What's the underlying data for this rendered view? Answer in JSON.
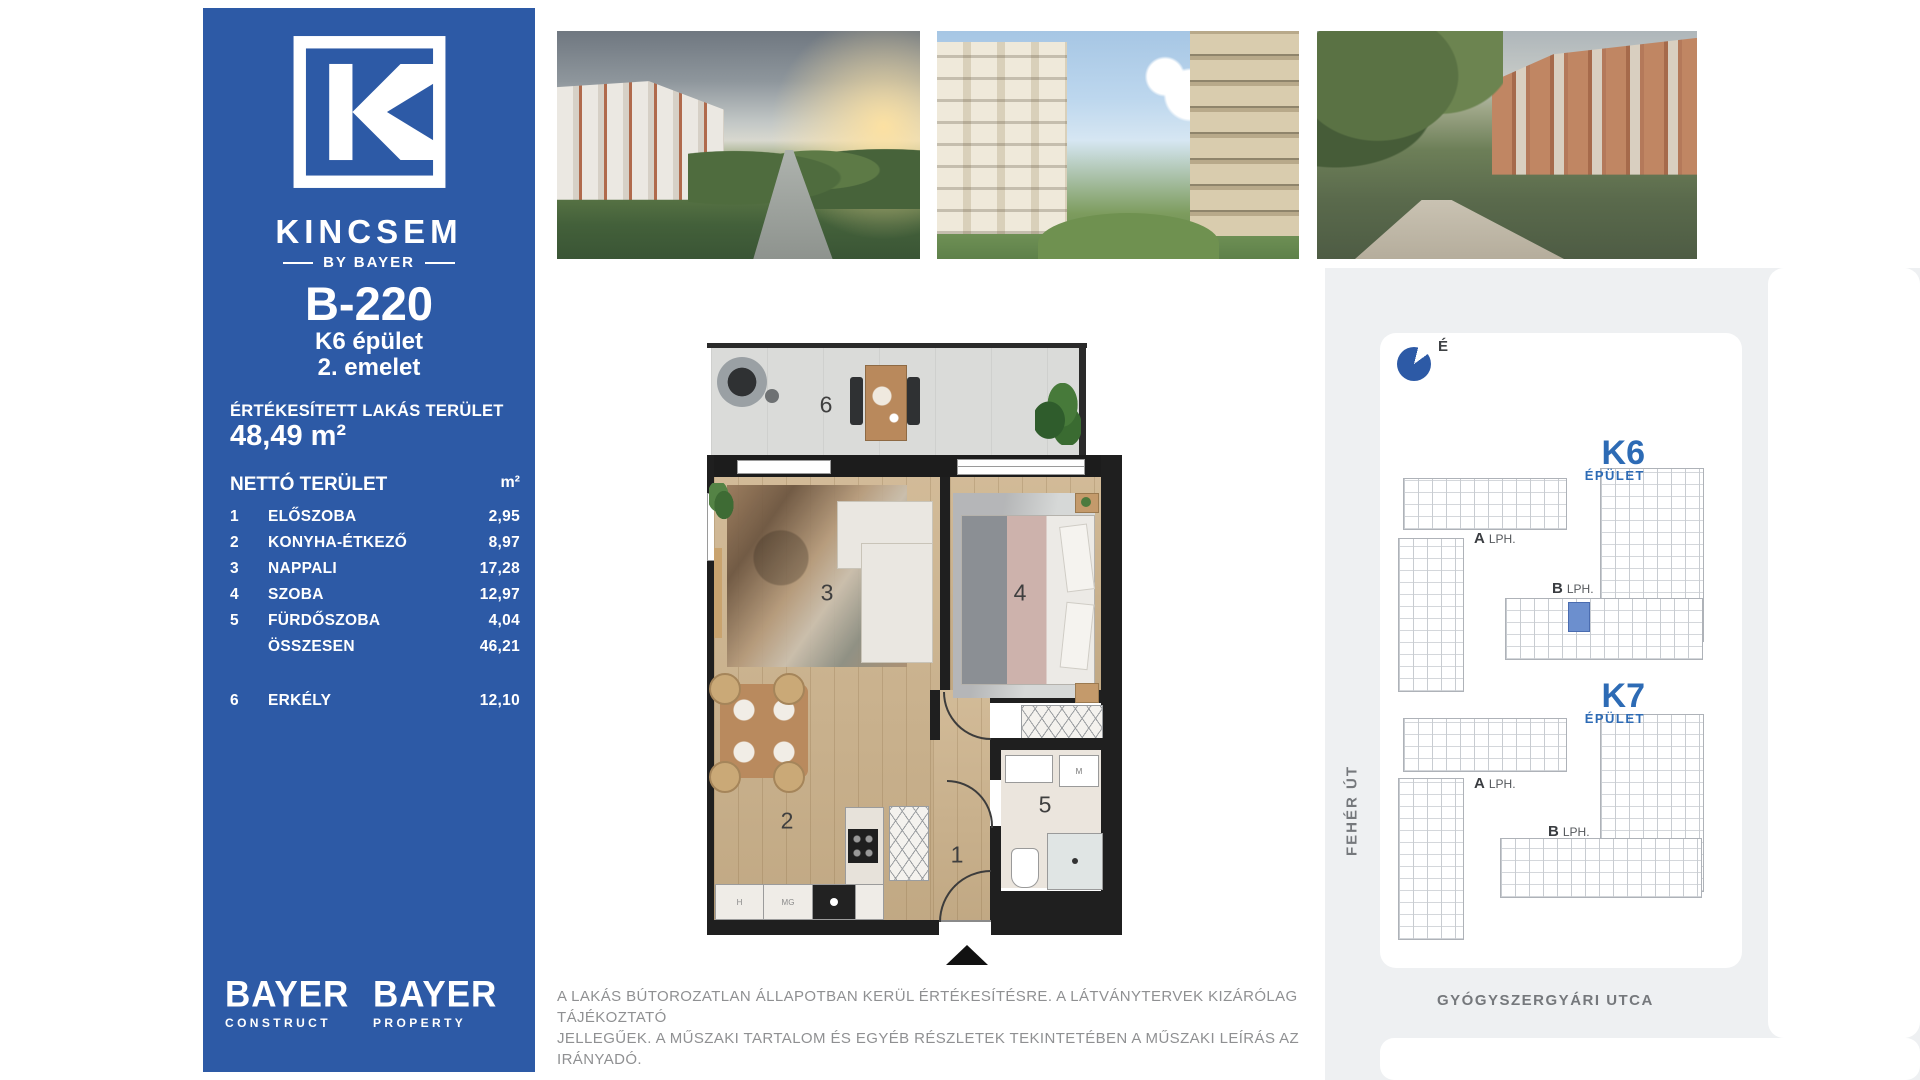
{
  "sidebar": {
    "brand": {
      "name": "KINCSEM",
      "byline": "BY BAYER"
    },
    "unit_id": "B-220",
    "building": "K6 épület",
    "floor": "2. emelet",
    "sold_area_label": "ÉRTÉKESÍTETT LAKÁS TERÜLET",
    "sold_area_value": "48,49 m²",
    "table": {
      "header": {
        "label": "NETTÓ TERÜLET",
        "unit": "m²"
      },
      "rows": [
        {
          "num": "1",
          "label": "ELŐSZOBA",
          "value": "2,95"
        },
        {
          "num": "2",
          "label": "KONYHA-ÉTKEZŐ",
          "value": "8,97"
        },
        {
          "num": "3",
          "label": "NAPPALI",
          "value": "17,28"
        },
        {
          "num": "4",
          "label": "SZOBA",
          "value": "12,97"
        },
        {
          "num": "5",
          "label": "FÜRDŐSZOBA",
          "value": "4,04"
        },
        {
          "num": "",
          "label": "ÖSSZESEN",
          "value": "46,21"
        },
        {
          "num": "6",
          "label": "ERKÉLY",
          "value": "12,10"
        }
      ]
    },
    "logos": [
      {
        "name": "BAYER",
        "sub": "CONSTRUCT"
      },
      {
        "name": "BAYER",
        "sub": "PROPERTY"
      }
    ]
  },
  "floorplan": {
    "rooms": {
      "hall": "1",
      "kitchen": "2",
      "living": "3",
      "bedroom": "4",
      "bathroom": "5",
      "balcony": "6"
    },
    "appliances": {
      "h": "H",
      "mg": "MG",
      "m": "M"
    }
  },
  "siteplan": {
    "compass_label": "É",
    "k6": {
      "name": "K6",
      "type": "ÉPÜLET",
      "lobbies": [
        {
          "letter": "A",
          "suffix": "LPH."
        },
        {
          "letter": "B",
          "suffix": "LPH."
        }
      ]
    },
    "k7": {
      "name": "K7",
      "type": "ÉPÜLET",
      "lobbies": [
        {
          "letter": "A",
          "suffix": "LPH."
        },
        {
          "letter": "B",
          "suffix": "LPH."
        }
      ]
    },
    "streets": {
      "left": "FEHÉR ÚT",
      "bottom": "GYÓGYSZERGYÁRI UTCA"
    }
  },
  "disclaimer": {
    "line1": "A LAKÁS BÚTOROZATLAN ÁLLAPOTBAN KERÜL ÉRTÉKESÍTÉSRE. A LÁTVÁNYTERVEK KIZÁRÓLAG TÁJÉKOZTATÓ",
    "line2": "JELLEGŰEK. A MŰSZAKI TARTALOM ÉS EGYÉB RÉSZLETEK TEKINTETÉBEN A MŰSZAKI LEÍRÁS AZ IRÁNYADÓ."
  },
  "colors": {
    "brand_blue": "#2d5aa6",
    "accent_blue": "#2d6bb5",
    "highlight_unit": "#6c8fce",
    "wall": "#1f1f1f",
    "disclaimer_gray": "#8f9092"
  }
}
